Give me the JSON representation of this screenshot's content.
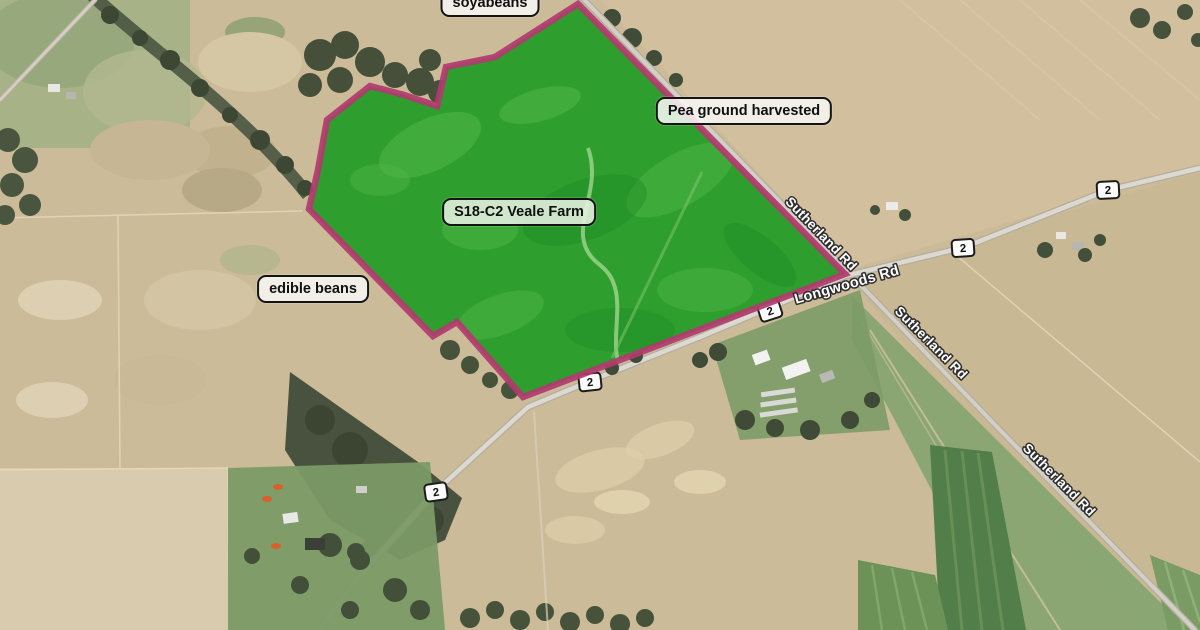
{
  "map": {
    "view": "satellite",
    "field": {
      "label": "S18-C2 Veale Farm",
      "fill_color": "#2e9f2e",
      "border_color": "#b23a6e"
    },
    "crop_labels": [
      {
        "text": "soyabeans"
      },
      {
        "text": "Pea ground harvested"
      },
      {
        "text": "edible beans"
      }
    ],
    "road_labels": [
      {
        "text": "Sutherland Rd"
      },
      {
        "text": "Longwoods Rd"
      },
      {
        "text": "Sutherland Rd"
      },
      {
        "text": "Sutherland Rd"
      }
    ],
    "route_shields": [
      {
        "number": "2"
      },
      {
        "number": "2"
      },
      {
        "number": "2"
      },
      {
        "number": "2"
      },
      {
        "number": "2"
      }
    ]
  }
}
